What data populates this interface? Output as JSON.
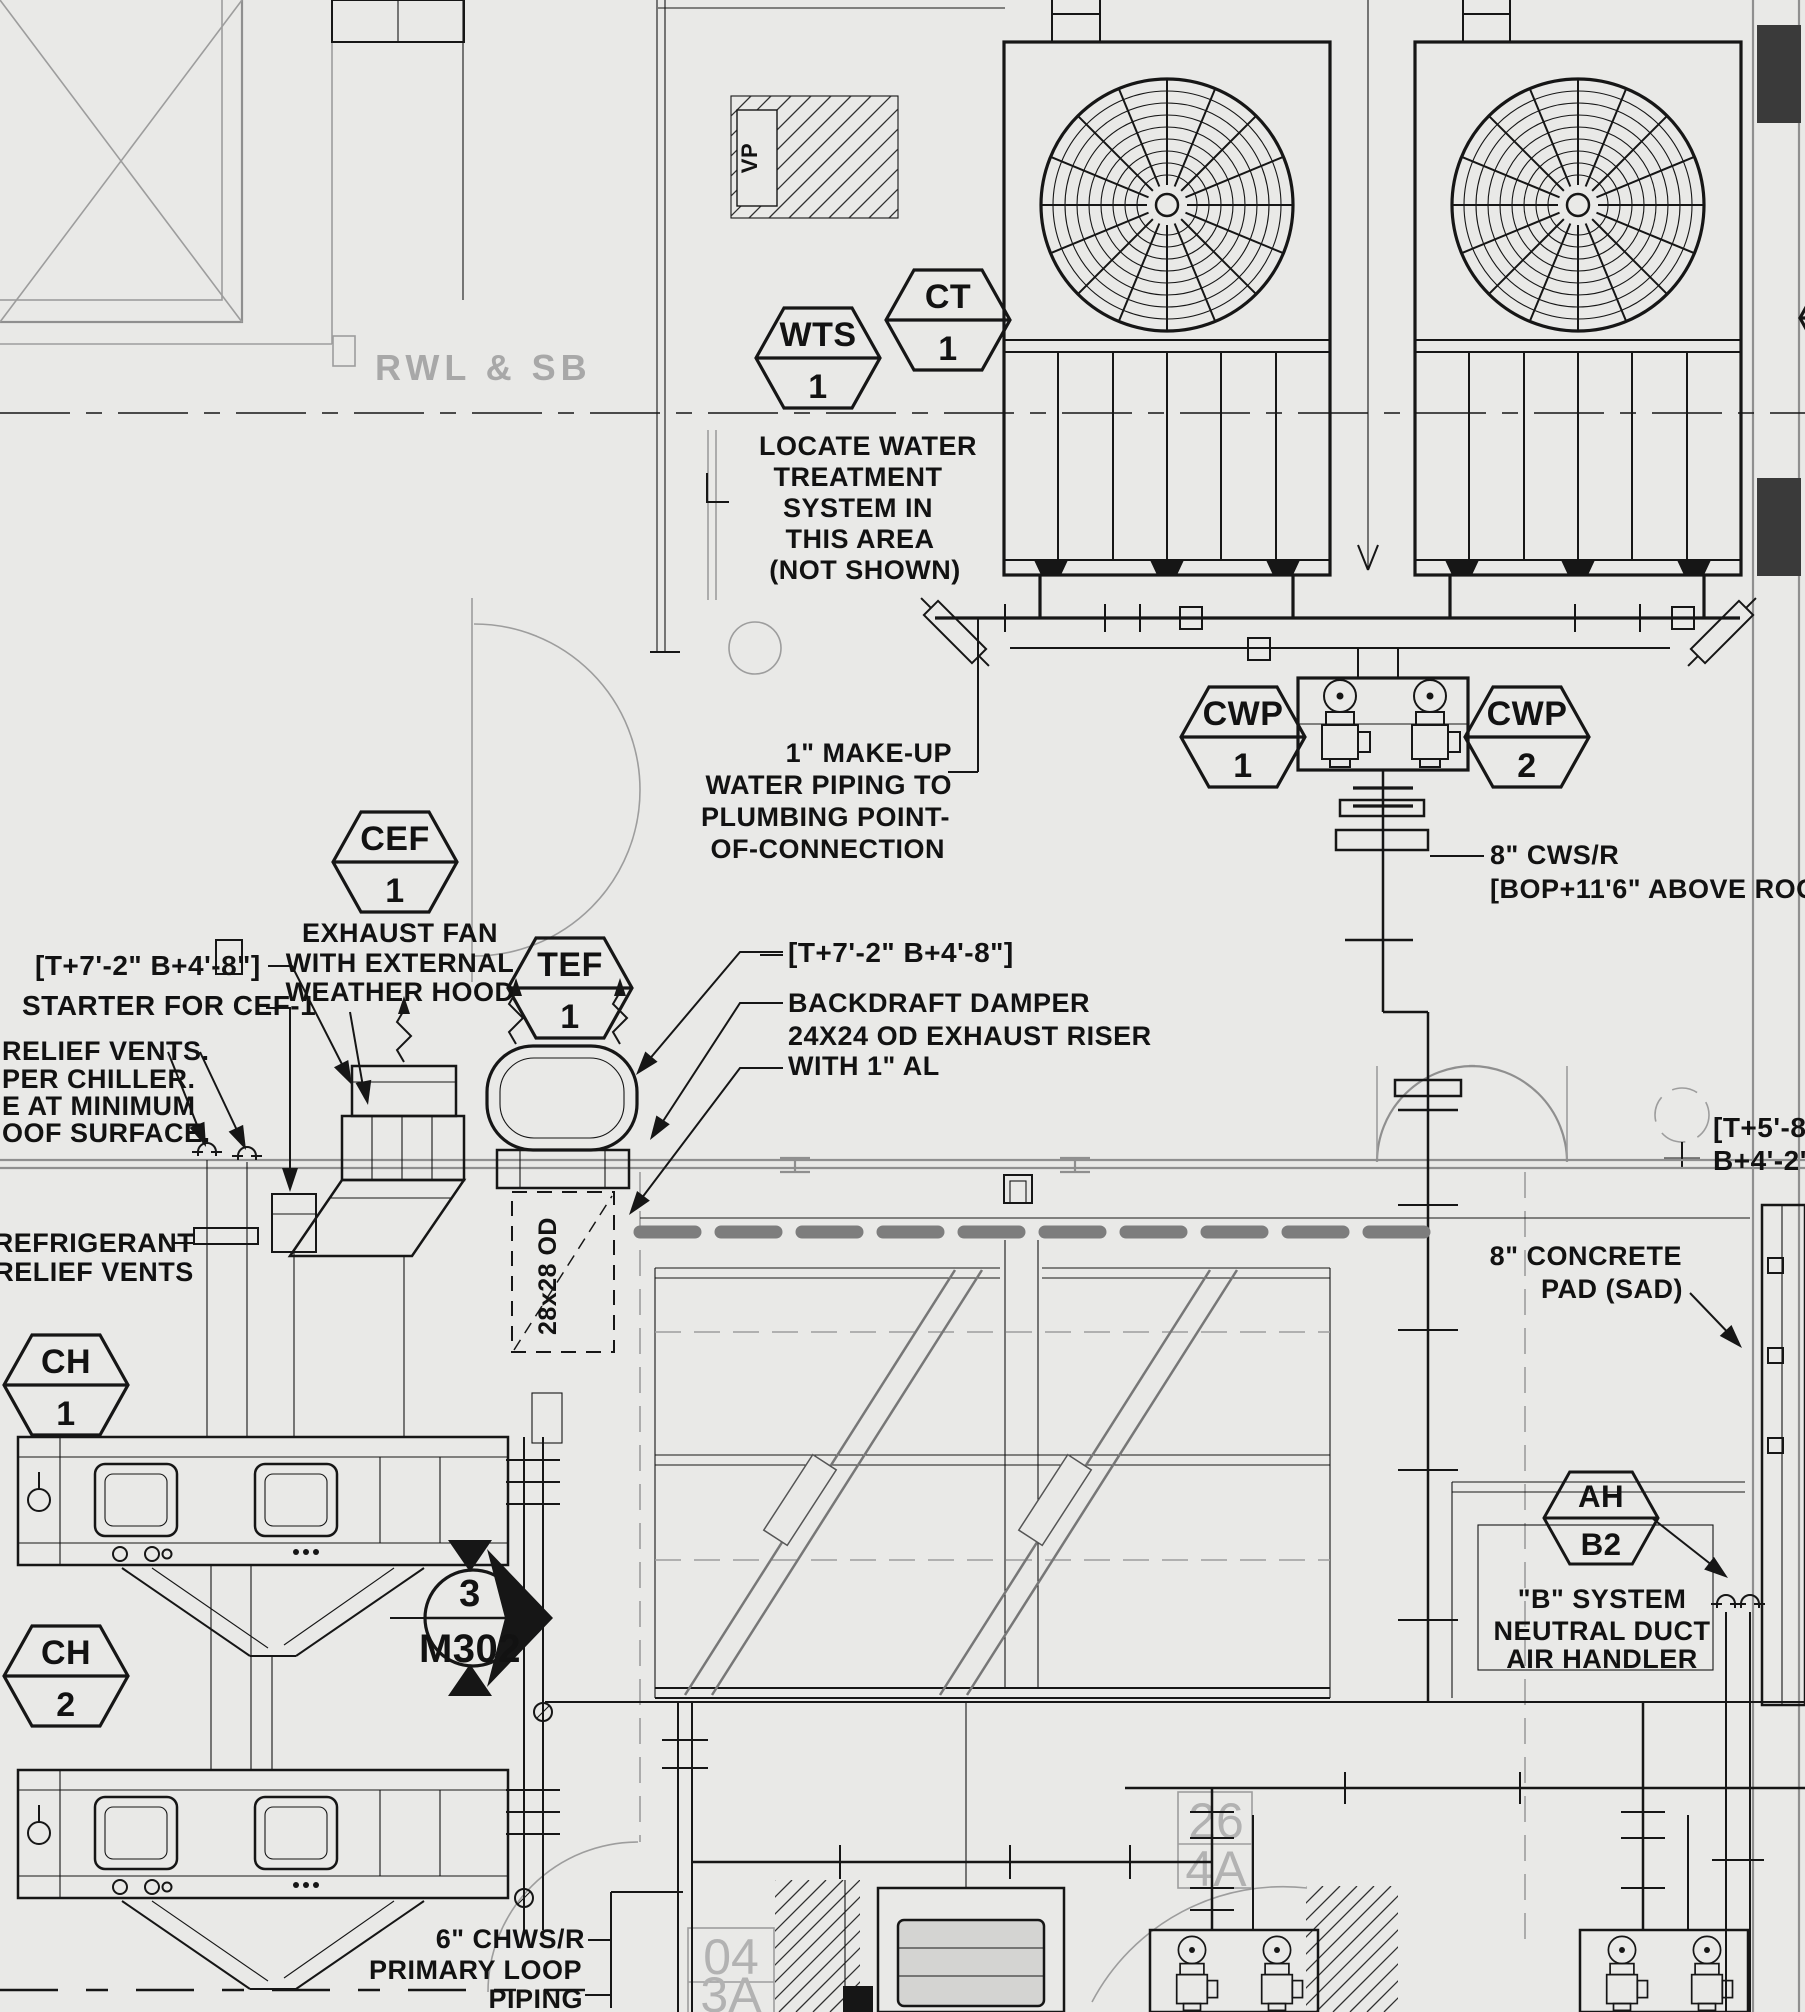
{
  "drawing": {
    "colors": {
      "background": "#e9e9e7",
      "ink": "#161616",
      "architecture_gray": "#9d9d9d",
      "roof_band_gray": "#7d7d7d"
    },
    "arch_text": {
      "rwl_sb": "RWL & SB"
    },
    "tags": {
      "wts": {
        "top": "WTS",
        "bottom": "1"
      },
      "ct": {
        "top": "CT",
        "bottom": "1"
      },
      "cwp1": {
        "top": "CWP",
        "bottom": "1"
      },
      "cwp2": {
        "top": "CWP",
        "bottom": "2"
      },
      "cef": {
        "top": "CEF",
        "bottom": "1"
      },
      "tef": {
        "top": "TEF",
        "bottom": "1"
      },
      "ch1": {
        "top": "CH",
        "bottom": "1"
      },
      "ch2": {
        "top": "CH",
        "bottom": "2"
      },
      "ah": {
        "top": "AH",
        "bottom": "B2"
      }
    },
    "labels": {
      "locate_water": [
        "LOCATE WATER",
        "TREATMENT",
        "SYSTEM IN",
        "THIS AREA",
        "(NOT SHOWN)"
      ],
      "makeup": [
        "1\" MAKE-UP",
        "WATER PIPING TO",
        "PLUMBING POINT-",
        "OF-CONNECTION"
      ],
      "cws": [
        "8\" CWS/R",
        "[BOP+11'6\" ABOVE ROOF]"
      ],
      "elev_left": "[T+7'-2\" B+4'-8\"]",
      "starter": "STARTER FOR CEF-1",
      "relief_note": [
        "RELIEF VENTS.",
        "PER CHILLER.",
        "E AT MINIMUM",
        "OOF SURFACE."
      ],
      "exhaust_fan": [
        "EXHAUST FAN",
        "WITH EXTERNAL",
        "WEATHER HOOD"
      ],
      "elev_right": "[T+7'-2\" B+4'-8\"]",
      "backdraft": [
        "BACKDRAFT DAMPER",
        "24X24 OD EXHAUST RISER",
        "WITH 1\" AL"
      ],
      "refrigerant": [
        "REFRIGERANT",
        "RELIEF VENTS"
      ],
      "concrete_pad": [
        "8\" CONCRETE",
        "PAD (SAD)"
      ],
      "b_system": [
        "\"B\" SYSTEM",
        "NEUTRAL DUCT",
        "AIR HANDLER"
      ],
      "elev_edge": [
        "[T+5'-8",
        "B+4'-2'"
      ],
      "chws": [
        "6\" CHWS/R",
        "PRIMARY LOOP",
        "PIPING"
      ],
      "duct_size": "28x28 OD",
      "vp": "VP"
    },
    "section_marker": {
      "number": "3",
      "sheet": "M302"
    },
    "grid_refs": {
      "g1": [
        "26",
        "4A"
      ],
      "g2": [
        "04",
        "3A"
      ]
    }
  }
}
